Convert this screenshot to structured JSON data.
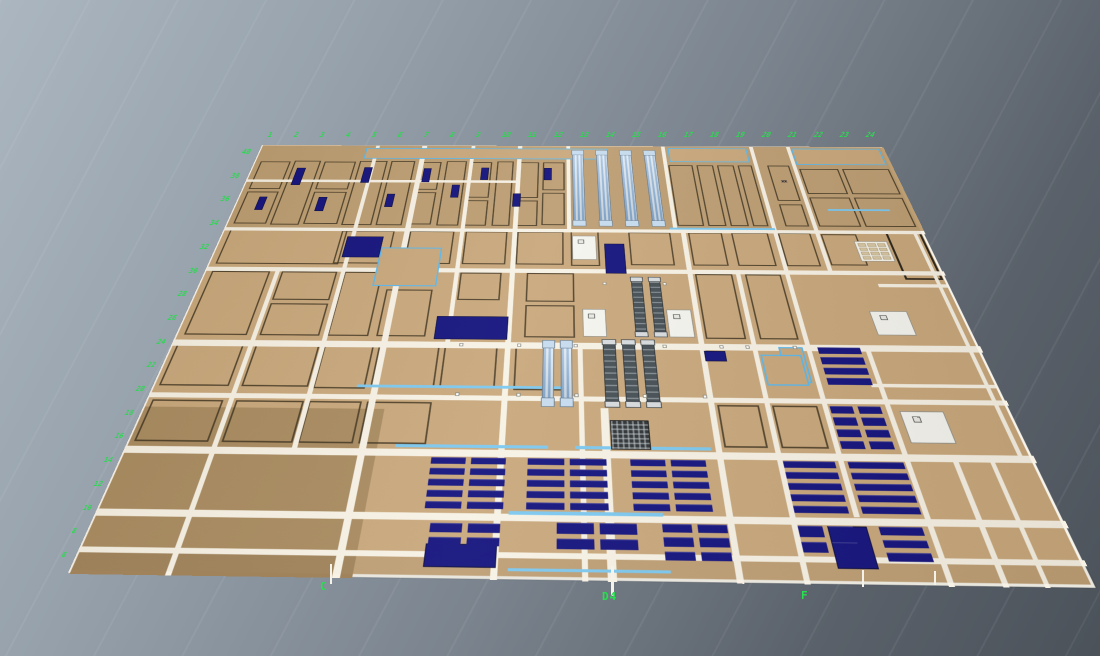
{
  "scene": {
    "width": 1100,
    "height": 656,
    "bg_top": "#abb6c0",
    "bg_bottom": "#4b525a"
  },
  "plan": {
    "width": 1000,
    "height": 700,
    "corners": [
      [
        262,
        145
      ],
      [
        882,
        147
      ],
      [
        1096,
        588
      ],
      [
        68,
        573
      ]
    ],
    "colors": {
      "floor": "#c9a87c",
      "floor_top": "#bd9e73",
      "floor_dark": "#a98b60",
      "corridor": "#f7f2e5",
      "navy": "#14137e",
      "cyan": "#5cb8ec",
      "cyan_line": "#7cc8f0",
      "green": "#2fd653",
      "rack_blue": "#86aed8",
      "rack_dark": "#454f55"
    },
    "zones": [
      {
        "rect": [
          0,
          0,
          1000,
          196
        ],
        "bg": "#bd9e73"
      },
      {
        "rect": [
          0,
          504,
          280,
          196
        ],
        "bg": "#a98b60"
      },
      {
        "rect": [
          0,
          676,
          1000,
          24
        ],
        "bg": "rgba(0,0,0,0.05)"
      }
    ],
    "rooms": [
      [
        8,
        42,
        48,
        68
      ],
      [
        8,
        116,
        48,
        72
      ],
      [
        62,
        40,
        42,
        150
      ],
      [
        110,
        42,
        50,
        68
      ],
      [
        110,
        116,
        50,
        72
      ],
      [
        166,
        40,
        44,
        150
      ],
      [
        216,
        40,
        38,
        150
      ],
      [
        262,
        42,
        34,
        68
      ],
      [
        262,
        116,
        34,
        72
      ],
      [
        304,
        40,
        32,
        150
      ],
      [
        344,
        42,
        32,
        86
      ],
      [
        344,
        134,
        32,
        56
      ],
      [
        384,
        40,
        26,
        150
      ],
      [
        418,
        42,
        32,
        86
      ],
      [
        418,
        134,
        32,
        56
      ],
      [
        456,
        42,
        34,
        68
      ],
      [
        456,
        116,
        34,
        72
      ],
      [
        652,
        48,
        38,
        140
      ],
      [
        696,
        48,
        26,
        140
      ],
      [
        728,
        48,
        26,
        140
      ],
      [
        760,
        48,
        22,
        140
      ],
      [
        806,
        48,
        34,
        84
      ],
      [
        806,
        140,
        34,
        48
      ],
      [
        854,
        56,
        60,
        60
      ],
      [
        920,
        56,
        72,
        60
      ],
      [
        854,
        124,
        60,
        64
      ],
      [
        920,
        124,
        72,
        64
      ],
      [
        8,
        200,
        170,
        70
      ],
      [
        170,
        202,
        76,
        66
      ],
      [
        268,
        202,
        64,
        66
      ],
      [
        348,
        202,
        60,
        66
      ],
      [
        422,
        202,
        66,
        66
      ],
      [
        498,
        200,
        40,
        70
      ],
      [
        580,
        202,
        60,
        66
      ],
      [
        665,
        202,
        48,
        66
      ],
      [
        726,
        202,
        52,
        66
      ],
      [
        792,
        202,
        46,
        66
      ],
      [
        852,
        204,
        50,
        62
      ],
      [
        8,
        284,
        80,
        112
      ],
      [
        104,
        284,
        76,
        52
      ],
      [
        104,
        342,
        76,
        54
      ],
      [
        190,
        284,
        52,
        112
      ],
      [
        252,
        316,
        62,
        80
      ],
      [
        348,
        284,
        56,
        50
      ],
      [
        438,
        284,
        64,
        52
      ],
      [
        438,
        342,
        64,
        54
      ],
      [
        665,
        284,
        50,
        112
      ],
      [
        732,
        284,
        48,
        112
      ],
      [
        5,
        410,
        84,
        64
      ],
      [
        104,
        410,
        80,
        64
      ],
      [
        190,
        410,
        62,
        66
      ],
      [
        258,
        410,
        76,
        64
      ],
      [
        340,
        410,
        66,
        64
      ],
      [
        428,
        410,
        70,
        66
      ],
      [
        5,
        494,
        84,
        56
      ],
      [
        104,
        494,
        80,
        56
      ],
      [
        190,
        494,
        62,
        56
      ],
      [
        258,
        494,
        76,
        56
      ],
      [
        665,
        494,
        48,
        56
      ],
      [
        728,
        494,
        52,
        56
      ]
    ],
    "rooms_dark": [
      [
        944,
        198,
        50,
        94
      ]
    ],
    "corridors_h": [
      [
        0,
        87,
        420,
        6
      ],
      [
        0,
        196,
        1000,
        7
      ],
      [
        0,
        276,
        1000,
        8
      ],
      [
        0,
        404,
        1000,
        10
      ],
      [
        0,
        484,
        1000,
        7
      ],
      [
        0,
        556,
        1000,
        9
      ],
      [
        0,
        631,
        1000,
        8
      ],
      [
        0,
        672,
        1000,
        6
      ],
      [
        905,
        300,
        90,
        6
      ],
      [
        850,
        462,
        148,
        5
      ]
    ],
    "corridors_v": [
      [
        95,
        280,
        6,
        420
      ],
      [
        185,
        0,
        6,
        556
      ],
      [
        260,
        0,
        8,
        700
      ],
      [
        340,
        0,
        6,
        404
      ],
      [
        415,
        0,
        7,
        700
      ],
      [
        493,
        0,
        6,
        196
      ],
      [
        505,
        404,
        6,
        296
      ],
      [
        530,
        500,
        9,
        200
      ],
      [
        645,
        0,
        6,
        196
      ],
      [
        655,
        196,
        7,
        504
      ],
      [
        720,
        276,
        6,
        424
      ],
      [
        786,
        0,
        6,
        630
      ],
      [
        845,
        0,
        6,
        276
      ],
      [
        858,
        404,
        6,
        296
      ],
      [
        910,
        556,
        6,
        144
      ],
      [
        950,
        560,
        5,
        140
      ],
      [
        983,
        196,
        5,
        360
      ]
    ],
    "rooms_cyan": [
      [
        170,
        6,
        388,
        28
      ],
      [
        655,
        4,
        126,
        36
      ],
      [
        852,
        4,
        140,
        42
      ],
      [
        232,
        236,
        86,
        74
      ],
      [
        752,
        408,
        30,
        54
      ],
      [
        728,
        420,
        50,
        46
      ]
    ],
    "navy_blocks": [
      [
        70,
        58,
        14,
        42
      ],
      [
        120,
        128,
        13,
        32
      ],
      [
        176,
        56,
        13,
        38
      ],
      [
        30,
        128,
        12,
        30
      ],
      [
        270,
        58,
        12,
        34
      ],
      [
        318,
        98,
        12,
        30
      ],
      [
        360,
        56,
        12,
        30
      ],
      [
        412,
        118,
        12,
        30
      ],
      [
        458,
        56,
        12,
        30
      ],
      [
        222,
        120,
        12,
        30
      ],
      [
        180,
        214,
        52,
        42
      ],
      [
        545,
        226,
        28,
        58
      ],
      [
        660,
        415,
        26,
        16
      ],
      [
        325,
        362,
        92,
        38
      ],
      [
        348,
        664,
        72,
        24
      ],
      [
        756,
        640,
        40,
        44
      ]
    ],
    "racks_striped": [
      [
        502,
        12,
        18,
        176
      ],
      [
        540,
        12,
        18,
        176
      ],
      [
        578,
        12,
        18,
        176
      ],
      [
        616,
        12,
        18,
        176
      ],
      [
        462,
        402,
        14,
        95
      ],
      [
        484,
        402,
        14,
        95
      ]
    ],
    "racks_dark": [
      [
        578,
        292,
        15,
        100
      ],
      [
        602,
        292,
        15,
        100
      ],
      [
        536,
        400,
        16,
        97
      ],
      [
        560,
        400,
        16,
        97
      ],
      [
        584,
        400,
        16,
        97
      ]
    ],
    "machines": [
      [
        500,
        210,
        34,
        48
      ],
      [
        512,
        348,
        30,
        46
      ],
      [
        620,
        348,
        32,
        46
      ],
      [
        872,
        500,
        50,
        42
      ],
      [
        880,
        348,
        48,
        40
      ]
    ],
    "machines_dark": [
      [
        540,
        516,
        44,
        38
      ]
    ],
    "panels": [
      {
        "x": 895,
        "y": 218,
        "w": 46,
        "h": 40,
        "rows": 4,
        "cols": 3
      }
    ],
    "desk_clusters": [
      {
        "x": 800,
        "y": 408,
        "w": 52,
        "h": 56,
        "rows": 4,
        "cols": 1
      },
      {
        "x": 794,
        "y": 494,
        "w": 58,
        "h": 56,
        "rows": 4,
        "cols": 2
      },
      {
        "x": 342,
        "y": 566,
        "w": 82,
        "h": 60,
        "rows": 5,
        "cols": 2
      },
      {
        "x": 448,
        "y": 566,
        "w": 86,
        "h": 60,
        "rows": 5,
        "cols": 2
      },
      {
        "x": 560,
        "y": 566,
        "w": 82,
        "h": 60,
        "rows": 5,
        "cols": 2
      },
      {
        "x": 726,
        "y": 566,
        "w": 56,
        "h": 60,
        "rows": 5,
        "cols": 1
      },
      {
        "x": 796,
        "y": 566,
        "w": 60,
        "h": 60,
        "rows": 5,
        "cols": 1
      },
      {
        "x": 350,
        "y": 642,
        "w": 72,
        "h": 24,
        "rows": 2,
        "cols": 2
      },
      {
        "x": 480,
        "y": 640,
        "w": 82,
        "h": 28,
        "rows": 2,
        "cols": 2
      },
      {
        "x": 588,
        "y": 640,
        "w": 66,
        "h": 38,
        "rows": 3,
        "cols": 2
      },
      {
        "x": 726,
        "y": 640,
        "w": 56,
        "h": 28,
        "rows": 2,
        "cols": 2
      },
      {
        "x": 808,
        "y": 640,
        "w": 44,
        "h": 36,
        "rows": 3,
        "cols": 1
      }
    ],
    "cyan_lines": [
      [
        300,
        550,
        170,
        4
      ],
      [
        500,
        550,
        150,
        4
      ],
      [
        242,
        470,
        250,
        4
      ],
      [
        430,
        628,
        160,
        4
      ],
      [
        432,
        688,
        160,
        3
      ],
      [
        875,
        150,
        90,
        4
      ],
      [
        640,
        192,
        150,
        4
      ]
    ],
    "door_markers": [
      [
        358,
        406
      ],
      [
        430,
        406
      ],
      [
        500,
        406
      ],
      [
        610,
        406
      ],
      [
        680,
        406
      ],
      [
        712,
        406
      ],
      [
        770,
        406
      ],
      [
        360,
        480
      ],
      [
        432,
        480
      ],
      [
        500,
        480
      ],
      [
        580,
        480
      ],
      [
        650,
        480
      ],
      [
        540,
        300
      ],
      [
        620,
        300
      ]
    ],
    "marks": [
      {
        "text": "xx",
        "x": 820,
        "y": 82
      }
    ]
  },
  "labels": {
    "axis_left": {
      "start": [
        242,
        148
      ],
      "step": [
        -10.6,
        23.7
      ],
      "values": [
        "40",
        "38",
        "36",
        "34",
        "32",
        "30",
        "28",
        "26",
        "24",
        "22",
        "20",
        "18",
        "16",
        "14",
        "12",
        "10",
        "8",
        "6"
      ]
    },
    "axis_top": {
      "start": [
        268,
        131
      ],
      "step": [
        26,
        0
      ],
      "values": [
        "1",
        "2",
        "3",
        "4",
        "5",
        "6",
        "7",
        "8",
        "9",
        "10",
        "11",
        "12",
        "13",
        "14",
        "15",
        "16",
        "17",
        "18",
        "19",
        "20",
        "21",
        "22",
        "23",
        "24"
      ]
    },
    "bottom": [
      {
        "text": "C",
        "x": 320,
        "y": 580
      },
      {
        "text": "D4",
        "x": 602,
        "y": 590
      },
      {
        "text": "F",
        "x": 801,
        "y": 589
      }
    ],
    "white_ticks": [
      [
        330,
        564,
        2,
        20
      ],
      [
        611,
        566,
        3,
        30
      ],
      [
        862,
        570,
        2,
        17
      ],
      [
        934,
        571,
        2,
        14
      ]
    ]
  }
}
